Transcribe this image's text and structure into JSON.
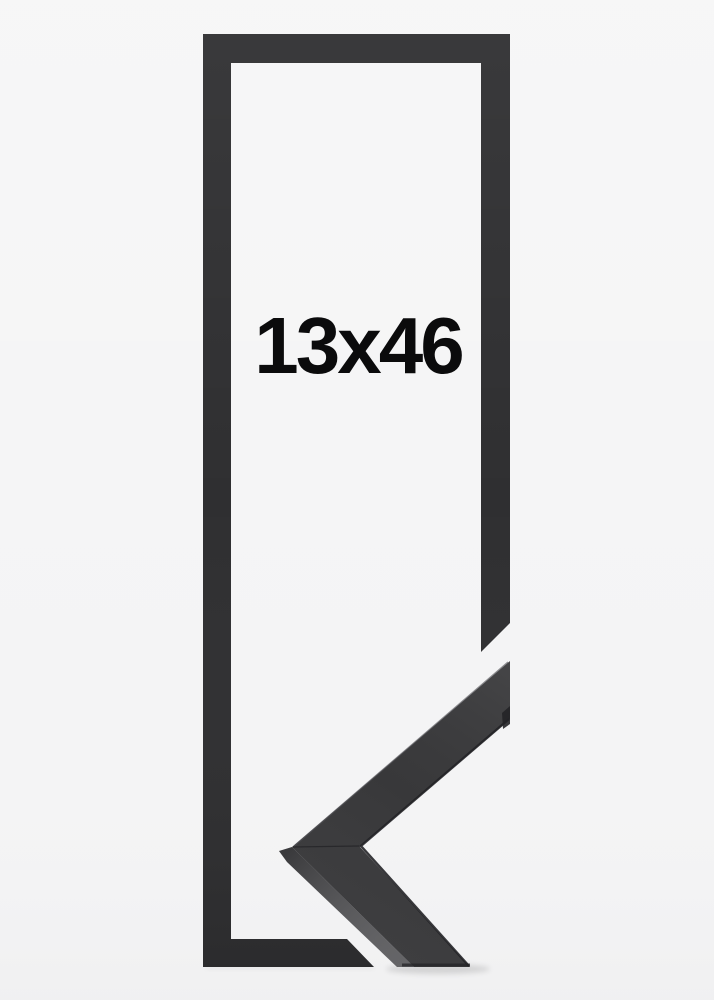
{
  "product": {
    "size_label": "13x46",
    "description": "Narrow black picture frame, front outline with mitered corner profile sample"
  },
  "colors": {
    "background": "#f4f4f5",
    "frame": "#2f2f31",
    "corner_face": "#3a3a3c",
    "corner_side": "#505053",
    "corner_edge_dark": "#242427",
    "label_text": "#0b0b0c"
  }
}
